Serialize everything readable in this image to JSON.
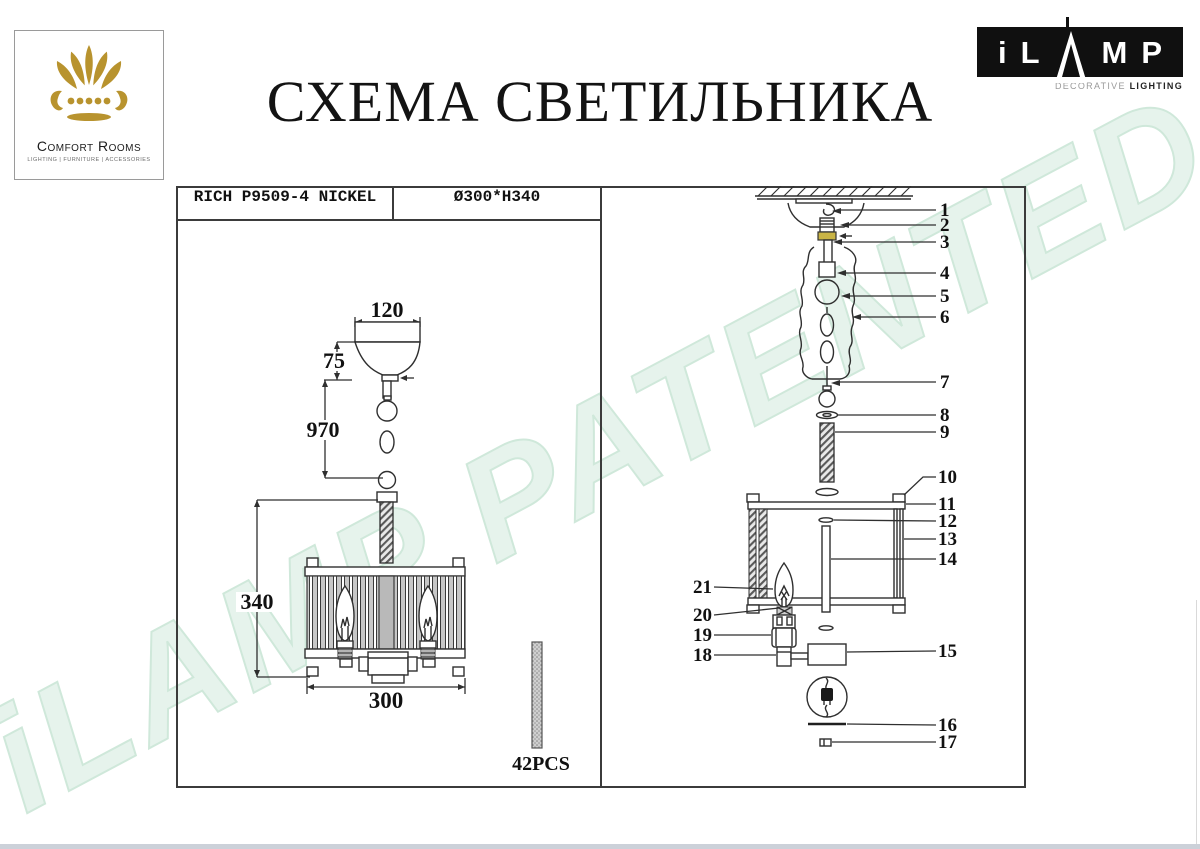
{
  "page": {
    "title": "СХЕМА СВЕТИЛЬНИКА"
  },
  "logos": {
    "comfort": {
      "name": "Comfort Rooms",
      "tagline": "LIGHTING  |  FURNITURE  |  ACCESSORIES"
    },
    "ilamp": {
      "l1": "i",
      "l2": "L",
      "l3": "M",
      "l4": "P",
      "sub_light": "DECORATIVE ",
      "sub_bold": "LIGHTING"
    }
  },
  "spec": {
    "model": "RICH P9509-4 NICKEL",
    "size": "Ø300*H340"
  },
  "dimensions": {
    "canopy_width": "120",
    "canopy_height": "75",
    "chain_length": "970",
    "shade_height": "340",
    "shade_diameter": "300",
    "rod_count": "42PCS"
  },
  "parts": [
    "1",
    "2",
    "3",
    "4",
    "5",
    "6",
    "7",
    "8",
    "9",
    "10",
    "11",
    "12",
    "13",
    "14",
    "15",
    "16",
    "17",
    "18",
    "19",
    "20",
    "21"
  ],
  "watermark": "iLAMP PATENTED",
  "colors": {
    "line": "#2f2f2f",
    "watermark_green": "#e6f3ec",
    "gold": "#b8932e",
    "nut_yellow": "#c9b445"
  }
}
